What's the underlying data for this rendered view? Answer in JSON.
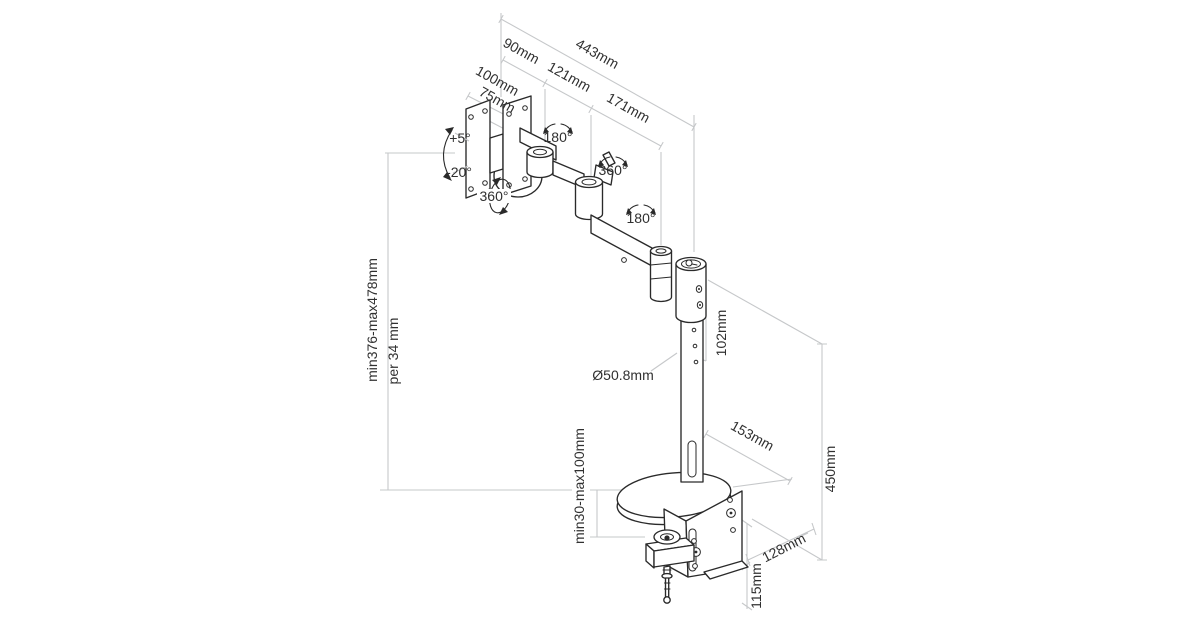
{
  "page": {
    "background": "#ffffff"
  },
  "colors": {
    "object_line": "#2a2a2a",
    "dimension_line": "#c6c8ca",
    "text": "#303030"
  },
  "drawing": {
    "type": "isometric-technical-line-drawing",
    "subject": "Desk-mounted single monitor arm with clamp base",
    "labels": {
      "overall_width": "443mm",
      "segment_1": "90mm",
      "segment_2": "121mm",
      "segment_3": "171mm",
      "vesa_width": "100mm",
      "vesa_height": "75mm",
      "tilt_up": "+5°",
      "tilt_down": "-20°",
      "swivel_plate": "360°",
      "rotate_joint_1": "180°",
      "rotate_joint_2": "360°",
      "rotate_pole": "180°",
      "height_range": "min376-max478mm",
      "height_step": "per 34 mm",
      "pole_top_section": "102mm",
      "pole_diameter": "Ø50.8mm",
      "base_depth": "153mm",
      "column_height": "450mm",
      "clamp_depth": "128mm",
      "clamp_height": "115mm",
      "clamp_capacity": "min30-max100mm"
    }
  }
}
